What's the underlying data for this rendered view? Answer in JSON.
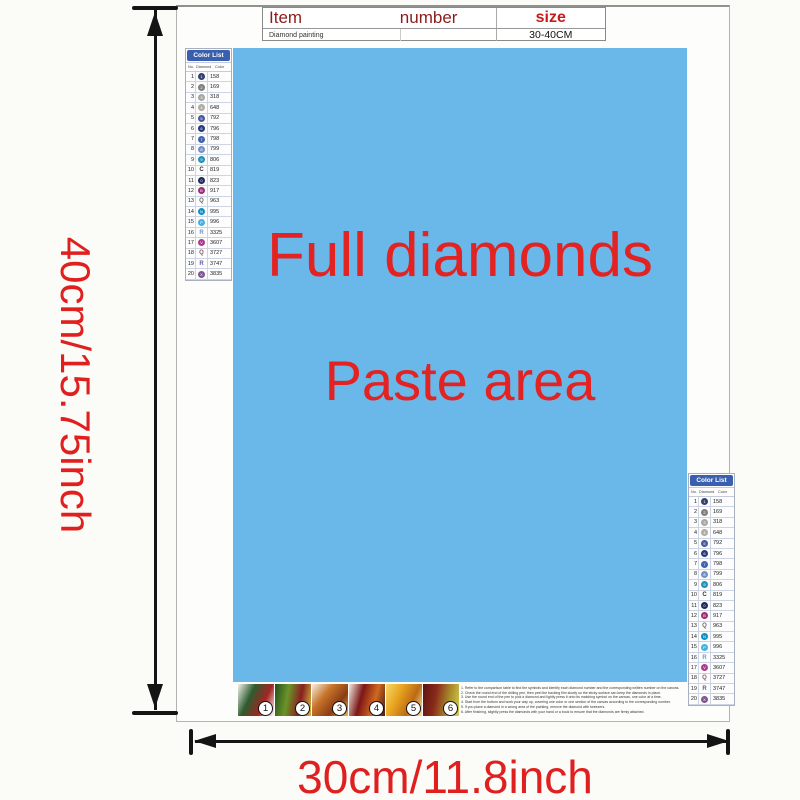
{
  "dimensions": {
    "height_label": "40cm/15.75inch",
    "width_label": "30cm/11.8inch",
    "label_color": "#e01f1f"
  },
  "item_table": {
    "col1_header": "Item",
    "col2_header": "number",
    "col3_header": "size",
    "row": {
      "item": "Diamond painting",
      "number": "",
      "size": "30-40CM"
    }
  },
  "paste_area": {
    "line1": "Full diamonds",
    "line2": "Paste area",
    "background": "#69b8e9",
    "text_color": "#e32222"
  },
  "color_list": {
    "title": "Color List",
    "headers": [
      "No.",
      "Diamond",
      "Color"
    ],
    "header_bg": "#3a5fae",
    "rows": [
      {
        "no": "1",
        "code": "158",
        "symbol": "circle",
        "color": "#35406e",
        "glyph": "1"
      },
      {
        "no": "2",
        "code": "169",
        "symbol": "circle",
        "color": "#7f7f7d",
        "glyph": "2"
      },
      {
        "no": "3",
        "code": "318",
        "symbol": "circle",
        "color": "#a6a6a4",
        "glyph": "3"
      },
      {
        "no": "4",
        "code": "648",
        "symbol": "circle",
        "color": "#b2aba1",
        "glyph": "4"
      },
      {
        "no": "5",
        "code": "792",
        "symbol": "circle",
        "color": "#4a579f",
        "glyph": "5"
      },
      {
        "no": "6",
        "code": "796",
        "symbol": "circle",
        "color": "#27397f",
        "glyph": "6"
      },
      {
        "no": "7",
        "code": "798",
        "symbol": "circle",
        "color": "#3d64ad",
        "glyph": "7"
      },
      {
        "no": "8",
        "code": "799",
        "symbol": "circle",
        "color": "#7390c6",
        "glyph": "8"
      },
      {
        "no": "9",
        "code": "806",
        "symbol": "circle",
        "color": "#2492b5",
        "glyph": "9"
      },
      {
        "no": "10",
        "code": "819",
        "symbol": "letter",
        "color": "#333333",
        "letter": "C"
      },
      {
        "no": "11",
        "code": "823",
        "symbol": "circle",
        "color": "#1e2a5c",
        "glyph": "0"
      },
      {
        "no": "12",
        "code": "917",
        "symbol": "circle",
        "color": "#9e2b75",
        "glyph": "B"
      },
      {
        "no": "13",
        "code": "963",
        "symbol": "letter",
        "color": "#666666",
        "letter": "Q"
      },
      {
        "no": "14",
        "code": "995",
        "symbol": "circle",
        "color": "#0d90c5",
        "glyph": "N"
      },
      {
        "no": "15",
        "code": "996",
        "symbol": "circle",
        "color": "#41b1df",
        "glyph": "P"
      },
      {
        "no": "16",
        "code": "3325",
        "symbol": "letter",
        "color": "#7094c4",
        "letter": "R"
      },
      {
        "no": "17",
        "code": "3607",
        "symbol": "circle",
        "color": "#ae3a8e",
        "glyph": "V"
      },
      {
        "no": "18",
        "code": "3727",
        "symbol": "letter",
        "color": "#8a5a68",
        "letter": "Q"
      },
      {
        "no": "19",
        "code": "3747",
        "symbol": "letter",
        "color": "#5a5c9e",
        "letter": "R"
      },
      {
        "no": "20",
        "code": "3835",
        "symbol": "circle",
        "color": "#7e5692",
        "glyph": "X"
      }
    ]
  },
  "steps": [
    {
      "num": "1",
      "angle": 115,
      "colors": [
        "#f2f2ea",
        "#2e5c2e",
        "#a32424",
        "#ffffff"
      ]
    },
    {
      "num": "2",
      "angle": 100,
      "colors": [
        "#244f1d",
        "#6a9428",
        "#8a1f1f",
        "#d2bc3e"
      ]
    },
    {
      "num": "3",
      "angle": 130,
      "colors": [
        "#f5f0e6",
        "#c8742a",
        "#8a3c14",
        "#e8b450"
      ]
    },
    {
      "num": "4",
      "angle": 105,
      "colors": [
        "#f0ece0",
        "#7c1616",
        "#d2691e",
        "#451a1a"
      ]
    },
    {
      "num": "5",
      "angle": 115,
      "colors": [
        "#f5d96a",
        "#e8a31e",
        "#bc6a14",
        "#f8ecac"
      ]
    },
    {
      "num": "6",
      "angle": 100,
      "colors": [
        "#5c1212",
        "#8a2a1a",
        "#a8892a",
        "#d2cc50"
      ]
    }
  ],
  "instructions": {
    "lines": [
      "1. Refer to the comparison table to find the symbols and identify each diamond number and the corresponding written number on the canvas.",
      "2. Check the round end of the drilling pen, then peel the backing film slowly so the sticky surface can keep the diamonds in place.",
      "3. Use the round end of the pen to pick a diamond and lightly press it onto its matching symbol on the canvas, one color at a time.",
      "4. Start from the bottom and work your way up, covering one color or one section of the canvas according to the corresponding number.",
      "5. If you place a diamond in a wrong area of the painting, remove the diamond with tweezers.",
      "6. After finishing, slightly press the diamonds with your hand or a book to ensure that the diamonds are firmly attached."
    ]
  }
}
